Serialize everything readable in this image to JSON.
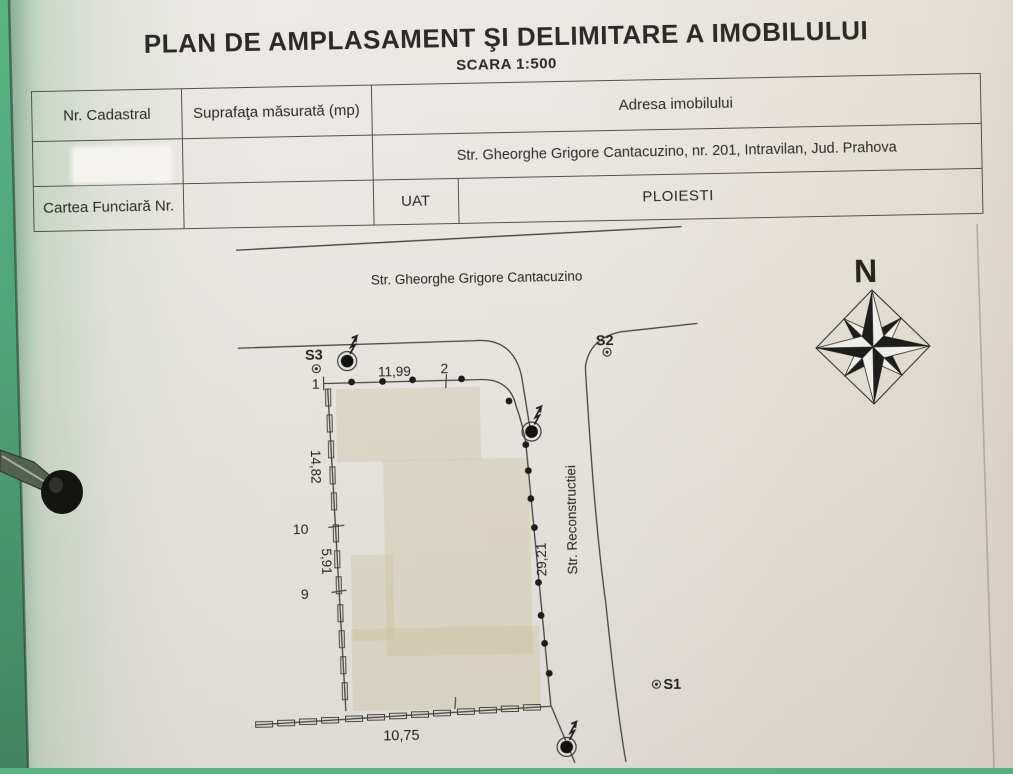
{
  "document": {
    "title": "PLAN DE AMPLASAMENT ŞI DELIMITARE A IMOBILULUI",
    "scale": "SCARA 1:500"
  },
  "table": {
    "nr_cadastral": "Nr. Cadastral",
    "suprafata": "Suprafaţa măsurată (mp)",
    "adresa_header": "Adresa imobilului",
    "adresa": "Str. Gheorghe Grigore Cantacuzino, nr. 201, Intravilan, Jud. Prahova",
    "cartea_funciara": "Cartea Funciară Nr.",
    "uat": "UAT",
    "uat_value": "PLOIESTI"
  },
  "plan": {
    "street_top": "Str. Gheorghe Grigore Cantacuzino",
    "street_right": "Str. Reconstructiei",
    "north": "N",
    "stations": {
      "s1": "S1",
      "s2": "S2",
      "s3": "S3"
    },
    "points": {
      "p1": "1",
      "p2": "2",
      "p9": "9",
      "p10": "10"
    },
    "dims": {
      "top": "11,99",
      "west_upper": "14,82",
      "west_lower": "5,91",
      "east": "29,21",
      "bottom": "10,75"
    }
  },
  "colors": {
    "paper": "#e9e6e2",
    "background_green": "#4fae7d",
    "ink": "#35332f",
    "building_fill": "#d6cdb2"
  }
}
